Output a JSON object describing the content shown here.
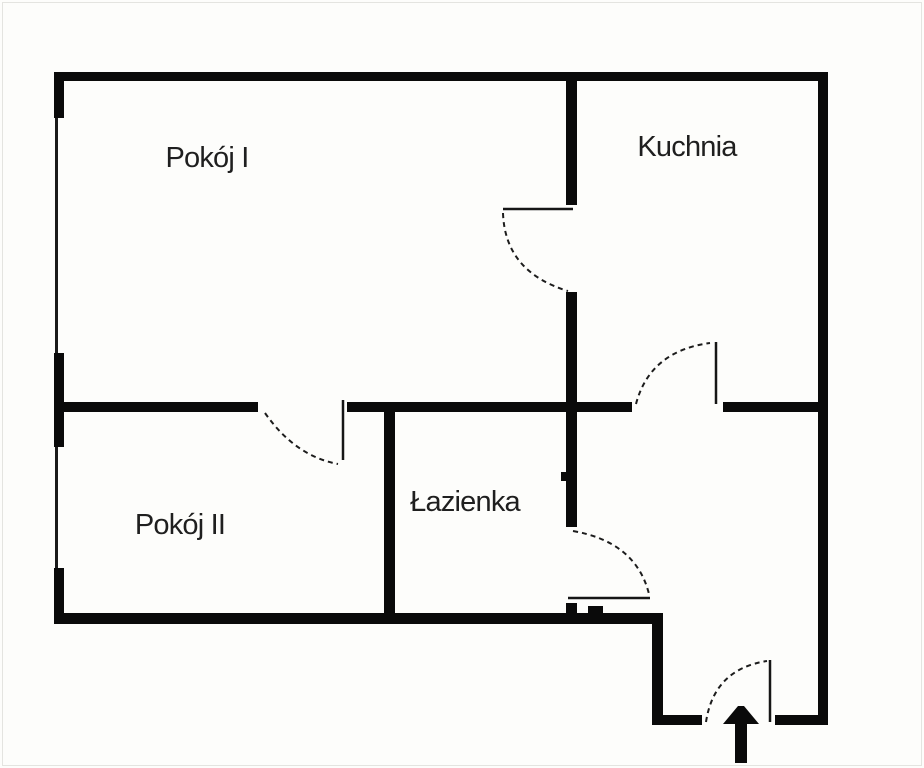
{
  "plan": {
    "type": "apartment-floor-plan",
    "rooms": [
      {
        "name": "pokoj-i",
        "label": "Pokój I"
      },
      {
        "name": "kuchnia",
        "label": "Kuchnia"
      },
      {
        "name": "pokoj-ii",
        "label": "Pokój II"
      },
      {
        "name": "lazienka",
        "label": "Łazienka"
      }
    ],
    "entrance": {
      "icon": "arrow-up-icon"
    },
    "counts": {
      "windows": 2,
      "interior_doors": 4,
      "entrance_doors": 1
    },
    "colors": {
      "background": "#fdfdfb",
      "wall": "#0a0a0a",
      "door_line": "#161616",
      "text": "#1f1f1f",
      "frame_border": "#e4e4e0"
    }
  }
}
